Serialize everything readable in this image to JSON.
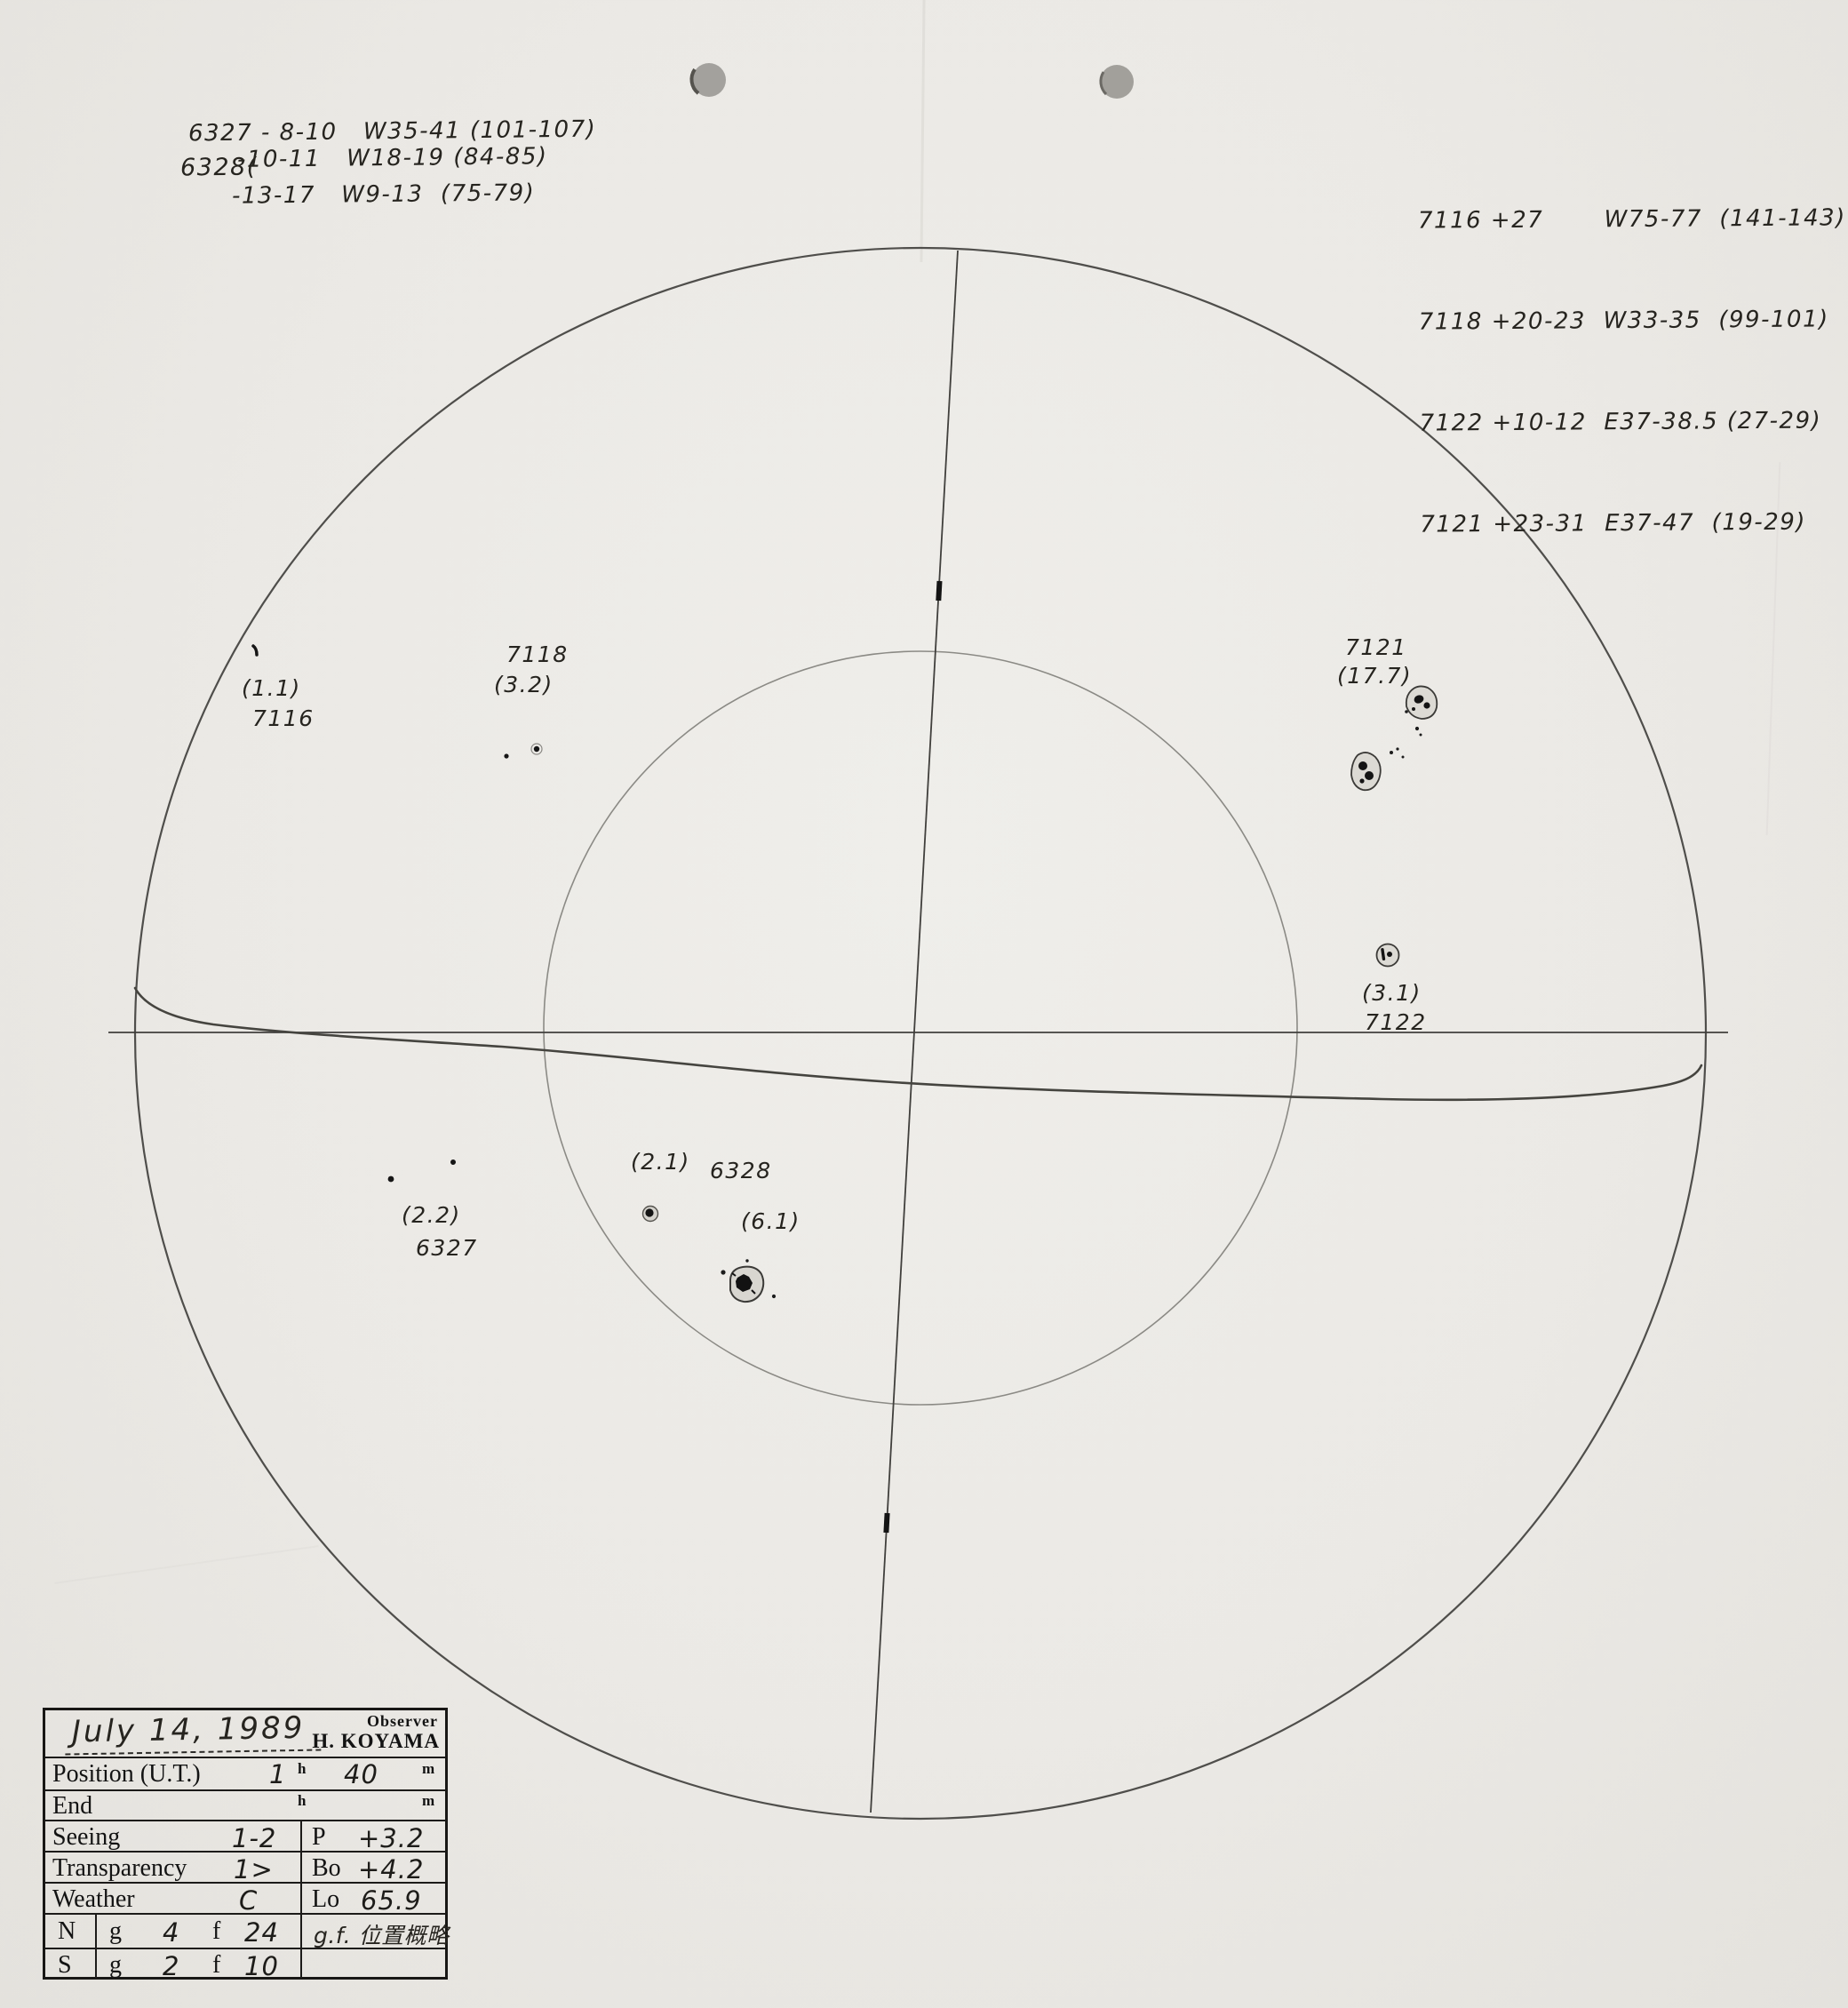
{
  "annotations": {
    "top_left": {
      "line1": "6327 - 8-10   W35-41 (101-107)",
      "brace_label": "6328(",
      "line2": "-10-11   W18-19 (84-85)",
      "line3": "-13-17   W9-13  (75-79)"
    },
    "top_right": {
      "line1": "7116 +27       W75-77  (141-143)",
      "line2": "7118 +20-23  W33-35  (99-101)",
      "line3": "7122 +10-12  E37-38.5 (27-29)",
      "line4": "7121 +23-31  E37-47  (19-29)"
    }
  },
  "disk_labels": {
    "g7116": {
      "count": "(1.1)",
      "id": "7116"
    },
    "g7118": {
      "id": "7118",
      "count": "(3.2)"
    },
    "g7121": {
      "id": "7121",
      "count": "(17.7)"
    },
    "g7122": {
      "count": "(3.1)",
      "id": "7122"
    },
    "g6328": {
      "count": "(2.1)",
      "id": "6328",
      "count2": "(6.1)"
    },
    "g6327": {
      "count": "(2.2)",
      "id": "6327"
    }
  },
  "table": {
    "date": "July 14, 1989",
    "observer_label": "Observer",
    "observer_name": "H. KOYAMA",
    "position_label": "Position (U.T.)",
    "position_hour": "1",
    "hour_unit": "h",
    "position_minute": "40",
    "minute_unit": "m",
    "end_label": "End",
    "seeing_label": "Seeing",
    "seeing_value": "1-2",
    "p_label": "P",
    "p_value": "+3.2",
    "transparency_label": "Transparency",
    "transparency_value": "1>",
    "bo_label": "Bo",
    "bo_value": "+4.2",
    "weather_label": "Weather",
    "weather_value": "C",
    "lo_label": "Lo",
    "lo_value": "65.9",
    "north_label": "N",
    "north_g_label": "g",
    "north_g_value": "4",
    "north_f_label": "f",
    "north_f_value": "24",
    "south_label": "S",
    "south_g_label": "g",
    "south_g_value": "2",
    "south_f_label": "f",
    "south_f_value": "10",
    "gf_note": "g.f. 位置概略"
  },
  "colors": {
    "paper": "#ebe9e5",
    "pencil": "#4a4a4a",
    "ink": "#1f1f1f",
    "punch_hole": "#a3a19d"
  }
}
